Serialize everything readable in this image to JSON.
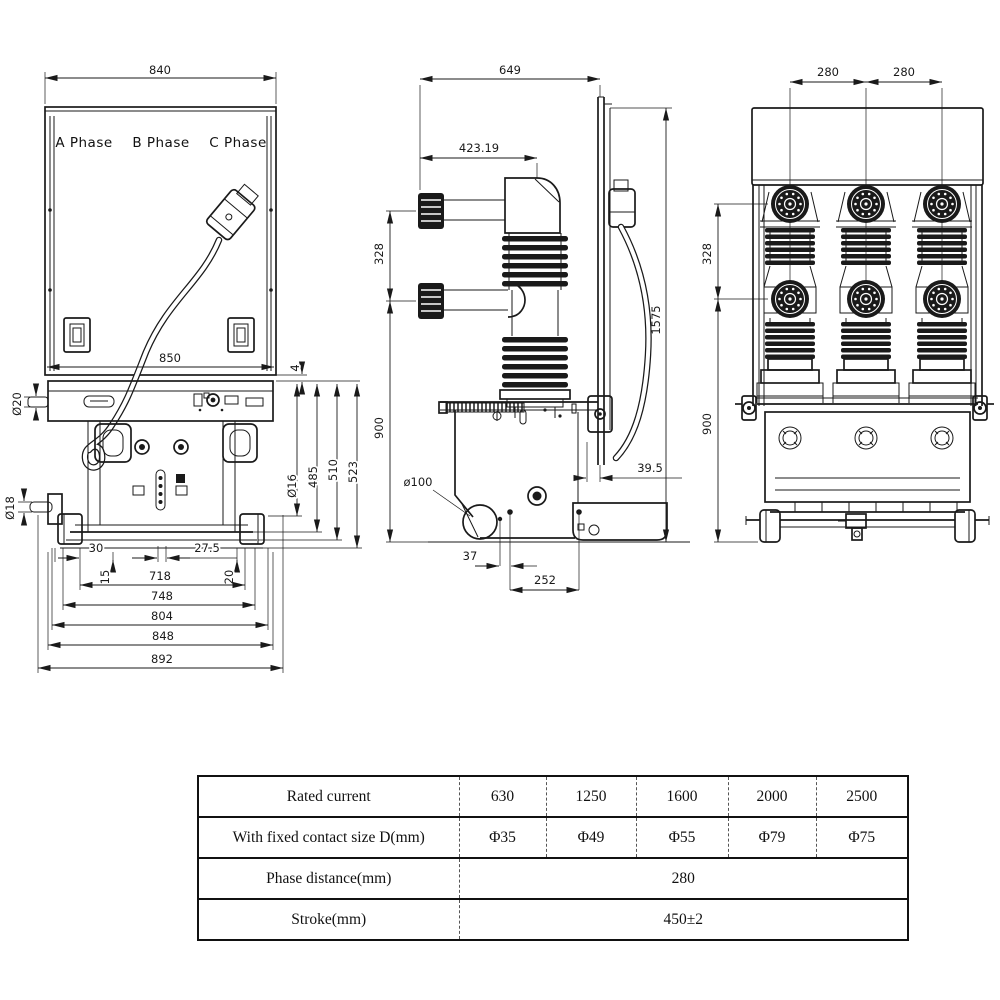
{
  "drawing": {
    "front": {
      "phase_a": "A Phase",
      "phase_b": "B Phase",
      "phase_c": "C Phase",
      "dim_840": "840",
      "dim_850": "850",
      "dim_4": "4",
      "dim_d20": "Ø20",
      "dim_d18": "Ø18",
      "dim_d16": "Ø16",
      "dim_485": "485",
      "dim_510": "510",
      "dim_523": "523",
      "dim_30": "30",
      "dim_27_5": "27.5",
      "dim_15": "15",
      "dim_718": "718",
      "dim_20": "20",
      "dim_748": "748",
      "dim_804": "804",
      "dim_848": "848",
      "dim_892": "892"
    },
    "side": {
      "dim_649": "649",
      "dim_423_19": "423.19",
      "dim_328": "328",
      "dim_900": "900",
      "dim_1575": "1575",
      "dim_d100": "ø100",
      "dim_39_5": "39.5",
      "dim_37": "37",
      "dim_252": "252"
    },
    "rear": {
      "dim_280_left": "280",
      "dim_280_right": "280",
      "dim_328": "328",
      "dim_900": "900"
    }
  },
  "table": {
    "rows": [
      {
        "label": "Rated current",
        "values": [
          "630",
          "1250",
          "1600",
          "2000",
          "2500"
        ]
      },
      {
        "label": "With fixed contact size D(mm)",
        "values": [
          "Φ35",
          "Φ49",
          "Φ55",
          "Φ79",
          "Φ75"
        ]
      },
      {
        "label": "Phase distance(mm)",
        "value": "280"
      },
      {
        "label": "Stroke(mm)",
        "value": "450±2"
      }
    ]
  },
  "colors": {
    "ink": "#1a1a1a",
    "background": "#ffffff"
  }
}
